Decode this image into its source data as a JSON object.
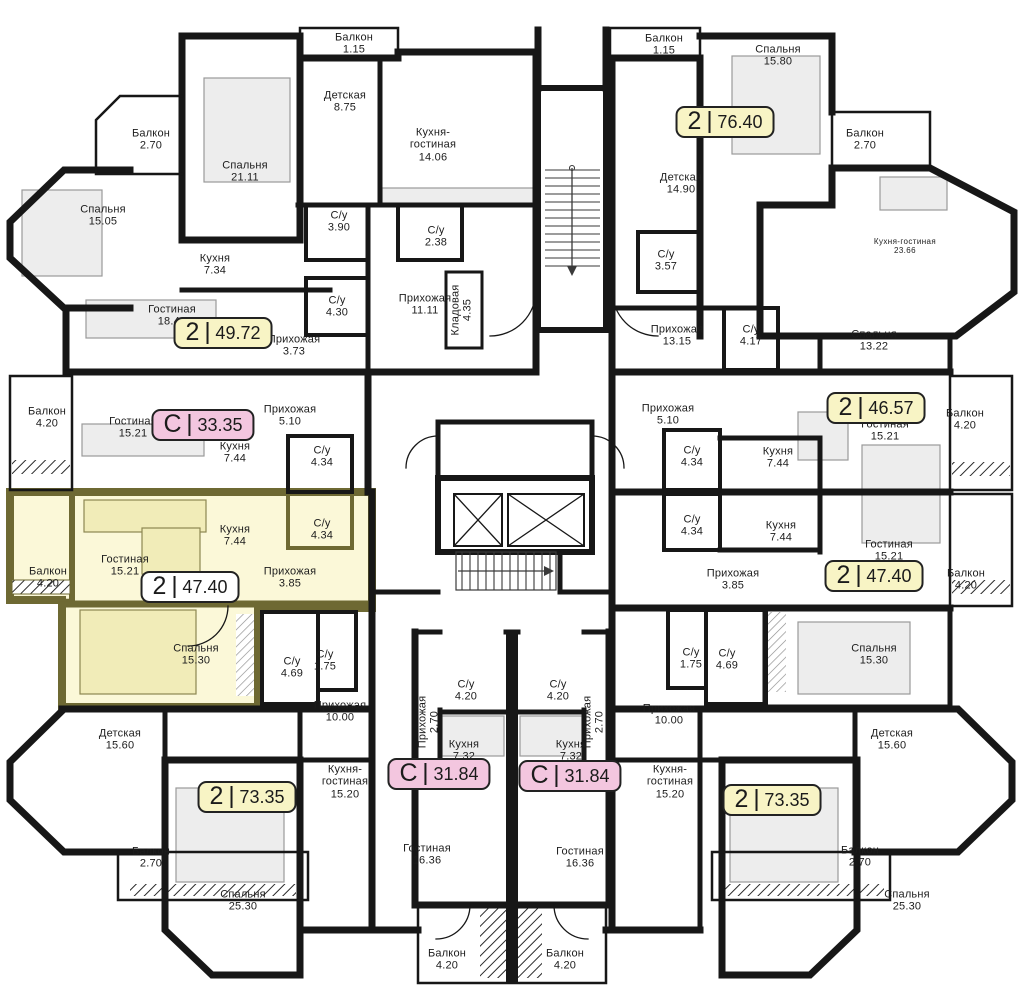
{
  "colors": {
    "wall": "#171717",
    "highlight_fill": "#FBF8D8",
    "highlight_wall": "#6E6933",
    "badge_yellow": "#F8F4C5",
    "badge_pink": "#F3C6DF",
    "badge_white": "#FFFFFF"
  },
  "badges": [
    {
      "type": "2",
      "area": "49.72",
      "variant": "yellow"
    },
    {
      "type": "С",
      "area": "33.35",
      "variant": "pink"
    },
    {
      "type": "2",
      "area": "47.40",
      "variant": "white"
    },
    {
      "type": "2",
      "area": "76.40",
      "variant": "yellow"
    },
    {
      "type": "2",
      "area": "46.57",
      "variant": "yellow"
    },
    {
      "type": "2",
      "area": "47.40",
      "variant": "yellow"
    },
    {
      "type": "2",
      "area": "73.35",
      "variant": "yellow"
    },
    {
      "type": "С",
      "area": "31.84",
      "variant": "pink"
    },
    {
      "type": "С",
      "area": "31.84",
      "variant": "pink"
    },
    {
      "type": "2",
      "area": "73.35",
      "variant": "yellow"
    }
  ],
  "rooms": [
    {
      "name": "Балкон",
      "area": "2.70"
    },
    {
      "name": "Спальня",
      "area": "21.11"
    },
    {
      "name": "Спальня",
      "area": "15.05"
    },
    {
      "name": "Кухня",
      "area": "7.34"
    },
    {
      "name": "Гостиная",
      "area": "18.49"
    },
    {
      "name": "Детская",
      "area": "8.75"
    },
    {
      "name": "Балкон",
      "area": "1.15"
    },
    {
      "name": "Кухня-гостиная",
      "area": "14.06"
    },
    {
      "name": "С/у",
      "area": "3.90"
    },
    {
      "name": "С/у",
      "area": "2.38"
    },
    {
      "name": "С/у",
      "area": "4.30"
    },
    {
      "name": "Прихожая",
      "area": "11.11"
    },
    {
      "name": "Кладовая",
      "area": "4.35"
    },
    {
      "name": "Прихожая",
      "area": "3.73"
    },
    {
      "name": "Балкон",
      "area": "4.20"
    },
    {
      "name": "Гостиная",
      "area": "15.21"
    },
    {
      "name": "Кухня",
      "area": "7.44"
    },
    {
      "name": "Прихожая",
      "area": "5.10"
    },
    {
      "name": "С/у",
      "area": "4.34"
    },
    {
      "name": "Балкон",
      "area": "4.20"
    },
    {
      "name": "Гостиная",
      "area": "15.21"
    },
    {
      "name": "Кухня",
      "area": "7.44"
    },
    {
      "name": "Прихожая",
      "area": "3.85"
    },
    {
      "name": "С/у",
      "area": "4.34"
    },
    {
      "name": "Спальня",
      "area": "15.30"
    },
    {
      "name": "С/у",
      "area": "4.69"
    },
    {
      "name": "С/у",
      "area": "1.75"
    },
    {
      "name": "Детская",
      "area": "15.60"
    },
    {
      "name": "Прихожая",
      "area": "10.00"
    },
    {
      "name": "Кухня-гостиная",
      "area": "15.20"
    },
    {
      "name": "Балкон",
      "area": "2.70"
    },
    {
      "name": "Спальня",
      "area": "25.30"
    },
    {
      "name": "С/у",
      "area": "4.20"
    },
    {
      "name": "Прихожая",
      "area": "2.70"
    },
    {
      "name": "Кухня",
      "area": "7.32"
    },
    {
      "name": "Гостиная",
      "area": "16.36"
    },
    {
      "name": "Балкон",
      "area": "4.20"
    },
    {
      "name": "С/у",
      "area": "4.20"
    },
    {
      "name": "Прихожая",
      "area": "2.70"
    },
    {
      "name": "Кухня",
      "area": "7.32"
    },
    {
      "name": "Гостиная",
      "area": "16.36"
    },
    {
      "name": "Балкон",
      "area": "4.20"
    },
    {
      "name": "Балкон",
      "area": "1.15"
    },
    {
      "name": "Спальня",
      "area": "15.80"
    },
    {
      "name": "Балкон",
      "area": "2.70"
    },
    {
      "name": "Детская",
      "area": "14.90"
    },
    {
      "name": "Кухня-гостиная",
      "area": "23.66"
    },
    {
      "name": "С/у",
      "area": "3.57"
    },
    {
      "name": "Прихожая",
      "area": "13.15"
    },
    {
      "name": "С/у",
      "area": "4.17"
    },
    {
      "name": "Спальня",
      "area": "13.22"
    },
    {
      "name": "Гостиная",
      "area": "15.21"
    },
    {
      "name": "Балкон",
      "area": "4.20"
    },
    {
      "name": "Прихожая",
      "area": "5.10"
    },
    {
      "name": "С/у",
      "area": "4.34"
    },
    {
      "name": "Кухня",
      "area": "7.44"
    },
    {
      "name": "С/у",
      "area": "4.34"
    },
    {
      "name": "Кухня",
      "area": "7.44"
    },
    {
      "name": "Гостиная",
      "area": "15.21"
    },
    {
      "name": "Прихожая",
      "area": "3.85"
    },
    {
      "name": "Балкон",
      "area": "4.20"
    },
    {
      "name": "С/у",
      "area": "1.75"
    },
    {
      "name": "С/у",
      "area": "4.69"
    },
    {
      "name": "Спальня",
      "area": "15.30"
    },
    {
      "name": "Прихожая",
      "area": "10.00"
    },
    {
      "name": "Детская",
      "area": "15.60"
    },
    {
      "name": "Кухня-гостиная",
      "area": "15.20"
    },
    {
      "name": "Балкон",
      "area": "2.70"
    },
    {
      "name": "Спальня",
      "area": "25.30"
    }
  ]
}
